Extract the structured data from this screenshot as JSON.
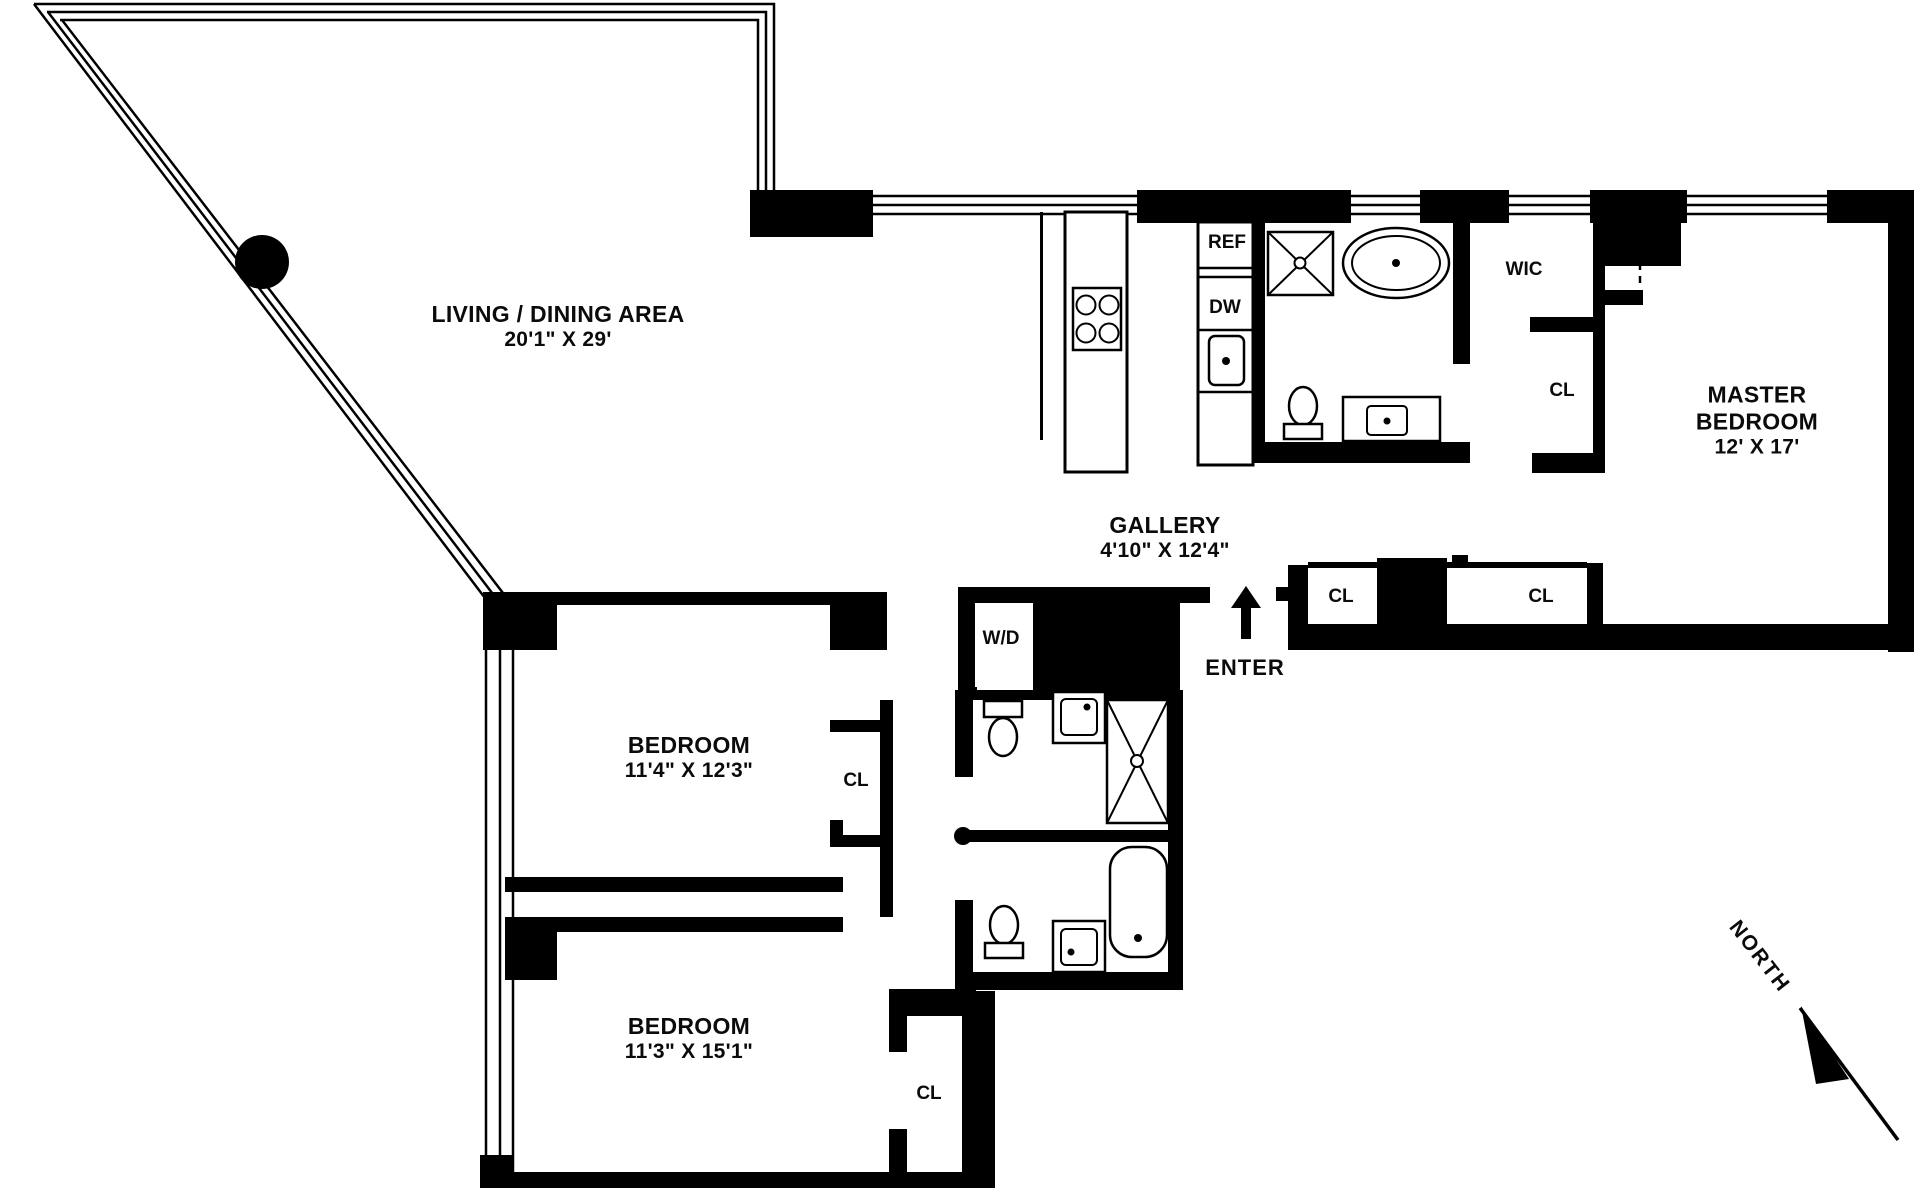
{
  "page": {
    "background": "#ffffff",
    "ink": "#000000"
  },
  "rooms": [
    {
      "id": "living-dining",
      "lines": [
        "LIVING / DINING AREA",
        "20'1\" X 29'"
      ]
    },
    {
      "id": "gallery",
      "lines": [
        "GALLERY",
        "4'10\" X 12'4\""
      ]
    },
    {
      "id": "master-bedroom",
      "lines": [
        "MASTER",
        "BEDROOM",
        "12' X 17'"
      ]
    },
    {
      "id": "bedroom-1",
      "lines": [
        "BEDROOM",
        "11'4\" X 12'3\""
      ]
    },
    {
      "id": "bedroom-2",
      "lines": [
        "BEDROOM",
        "11'3\" X 15'1\""
      ]
    }
  ],
  "closets": [
    {
      "id": "walk-in-closet",
      "label": "WIC"
    },
    {
      "id": "master-closet",
      "label": "CL"
    },
    {
      "id": "hall-closet-1",
      "label": "CL"
    },
    {
      "id": "hall-closet-2",
      "label": "CL"
    },
    {
      "id": "bedroom-1-closet",
      "label": "CL"
    },
    {
      "id": "bedroom-2-closet",
      "label": "CL"
    }
  ],
  "appliances": [
    {
      "id": "refrigerator",
      "label": "REF"
    },
    {
      "id": "dishwasher",
      "label": "DW"
    },
    {
      "id": "washer-dryer",
      "label": "W/D"
    }
  ],
  "entry": {
    "label": "ENTER"
  },
  "compass": {
    "label": "NORTH"
  },
  "fixtures": [
    "structural-column",
    "kitchen-island",
    "cooktop",
    "kitchen-sink",
    "shower",
    "oval-bathtub",
    "bathtub",
    "toilet",
    "vanity-sink"
  ]
}
